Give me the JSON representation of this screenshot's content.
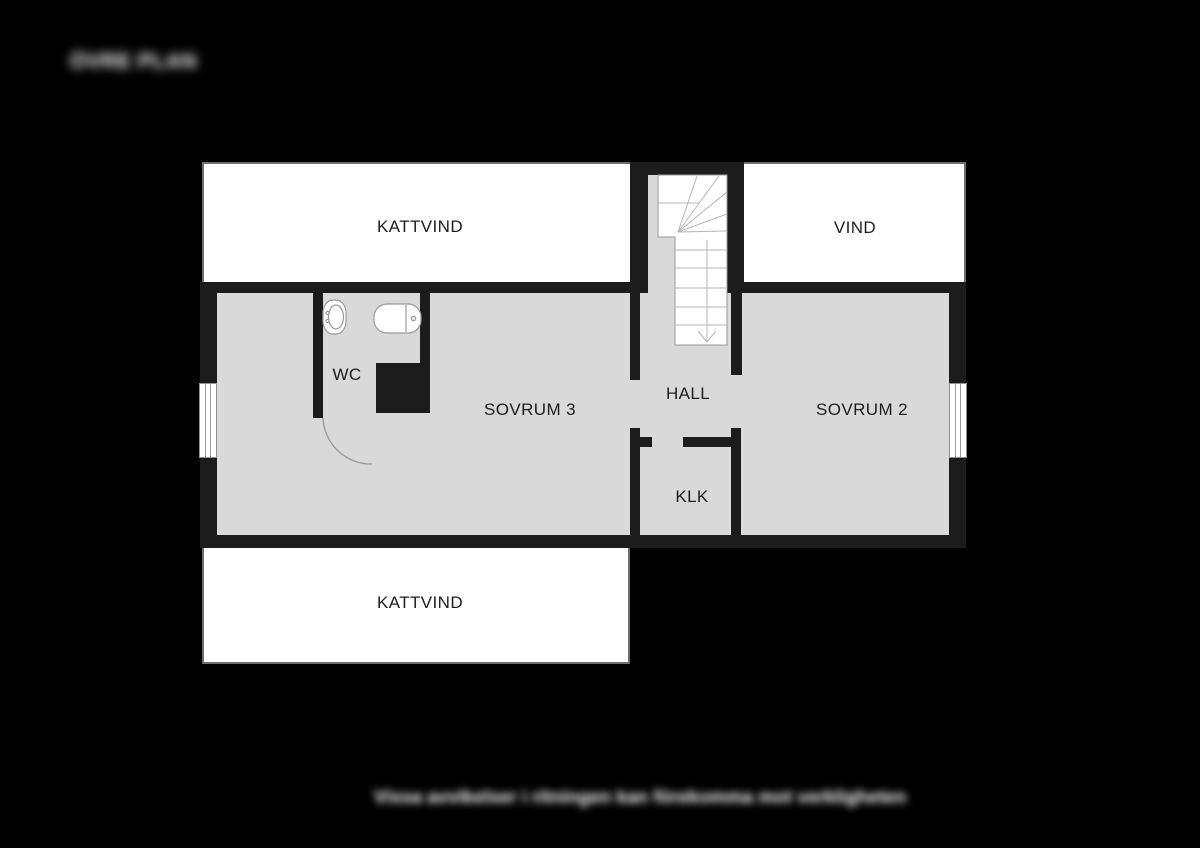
{
  "title": {
    "text": "ÖVRE PLAN"
  },
  "disclaimer": {
    "text": "Vissa avvikelser i ritningen kan förekomma mot verkligheten"
  },
  "rooms": {
    "kattvind_top": {
      "label": "KATTVIND"
    },
    "vind": {
      "label": "VIND"
    },
    "wc": {
      "label": "WC"
    },
    "sovrum3": {
      "label": "SOVRUM 3"
    },
    "hall": {
      "label": "HALL"
    },
    "sovrum2": {
      "label": "SOVRUM 2"
    },
    "klk": {
      "label": "KLK"
    },
    "kattvind_bottom": {
      "label": "KATTVIND"
    }
  },
  "colors": {
    "background": "#000000",
    "wall": "#1c1c1c",
    "floor_gray": "#d9d9d9",
    "room_white": "#ffffff",
    "thin_outline": "#6e6e6e",
    "stair_lines": "#b5b5b5",
    "label_text": "#1d1d1b",
    "overlay_text": "#ffffff"
  }
}
